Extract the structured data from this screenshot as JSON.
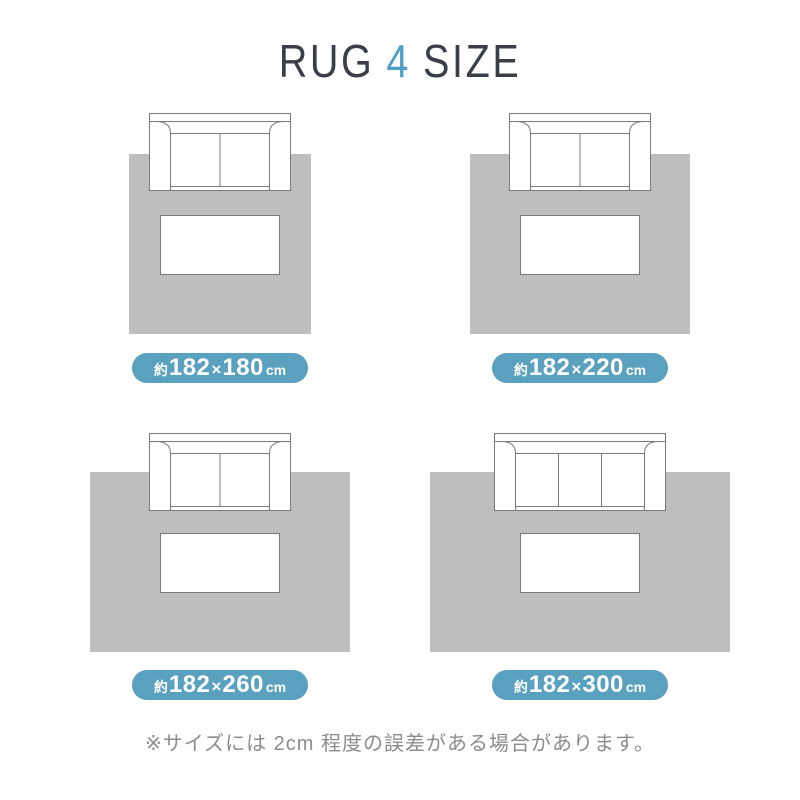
{
  "title": {
    "word1": "RUG",
    "number": "4",
    "word2": "SIZE"
  },
  "colors": {
    "title_dark": "#3A3E47",
    "accent_blue": "#4D9FC8",
    "rug_gray": "#BEBEBE",
    "badge_teal": "#59A1BE",
    "line_gray": "#7B7B7B",
    "footnote_gray": "#8C8C8C",
    "page_bg": "#FFFFFF"
  },
  "panels": [
    {
      "rug_cm": "182×180",
      "sofa_seats": 2,
      "badge": {
        "approx": "約",
        "width": "182",
        "times": "×",
        "length": "180",
        "unit": "cm"
      }
    },
    {
      "rug_cm": "182×220",
      "sofa_seats": 2,
      "badge": {
        "approx": "約",
        "width": "182",
        "times": "×",
        "length": "220",
        "unit": "cm"
      }
    },
    {
      "rug_cm": "182×260",
      "sofa_seats": 2,
      "badge": {
        "approx": "約",
        "width": "182",
        "times": "×",
        "length": "260",
        "unit": "cm"
      }
    },
    {
      "rug_cm": "182×300",
      "sofa_seats": 3,
      "badge": {
        "approx": "約",
        "width": "182",
        "times": "×",
        "length": "300",
        "unit": "cm"
      }
    }
  ],
  "footnote": "※サイズには 2cm 程度の誤差がある場合があります。"
}
